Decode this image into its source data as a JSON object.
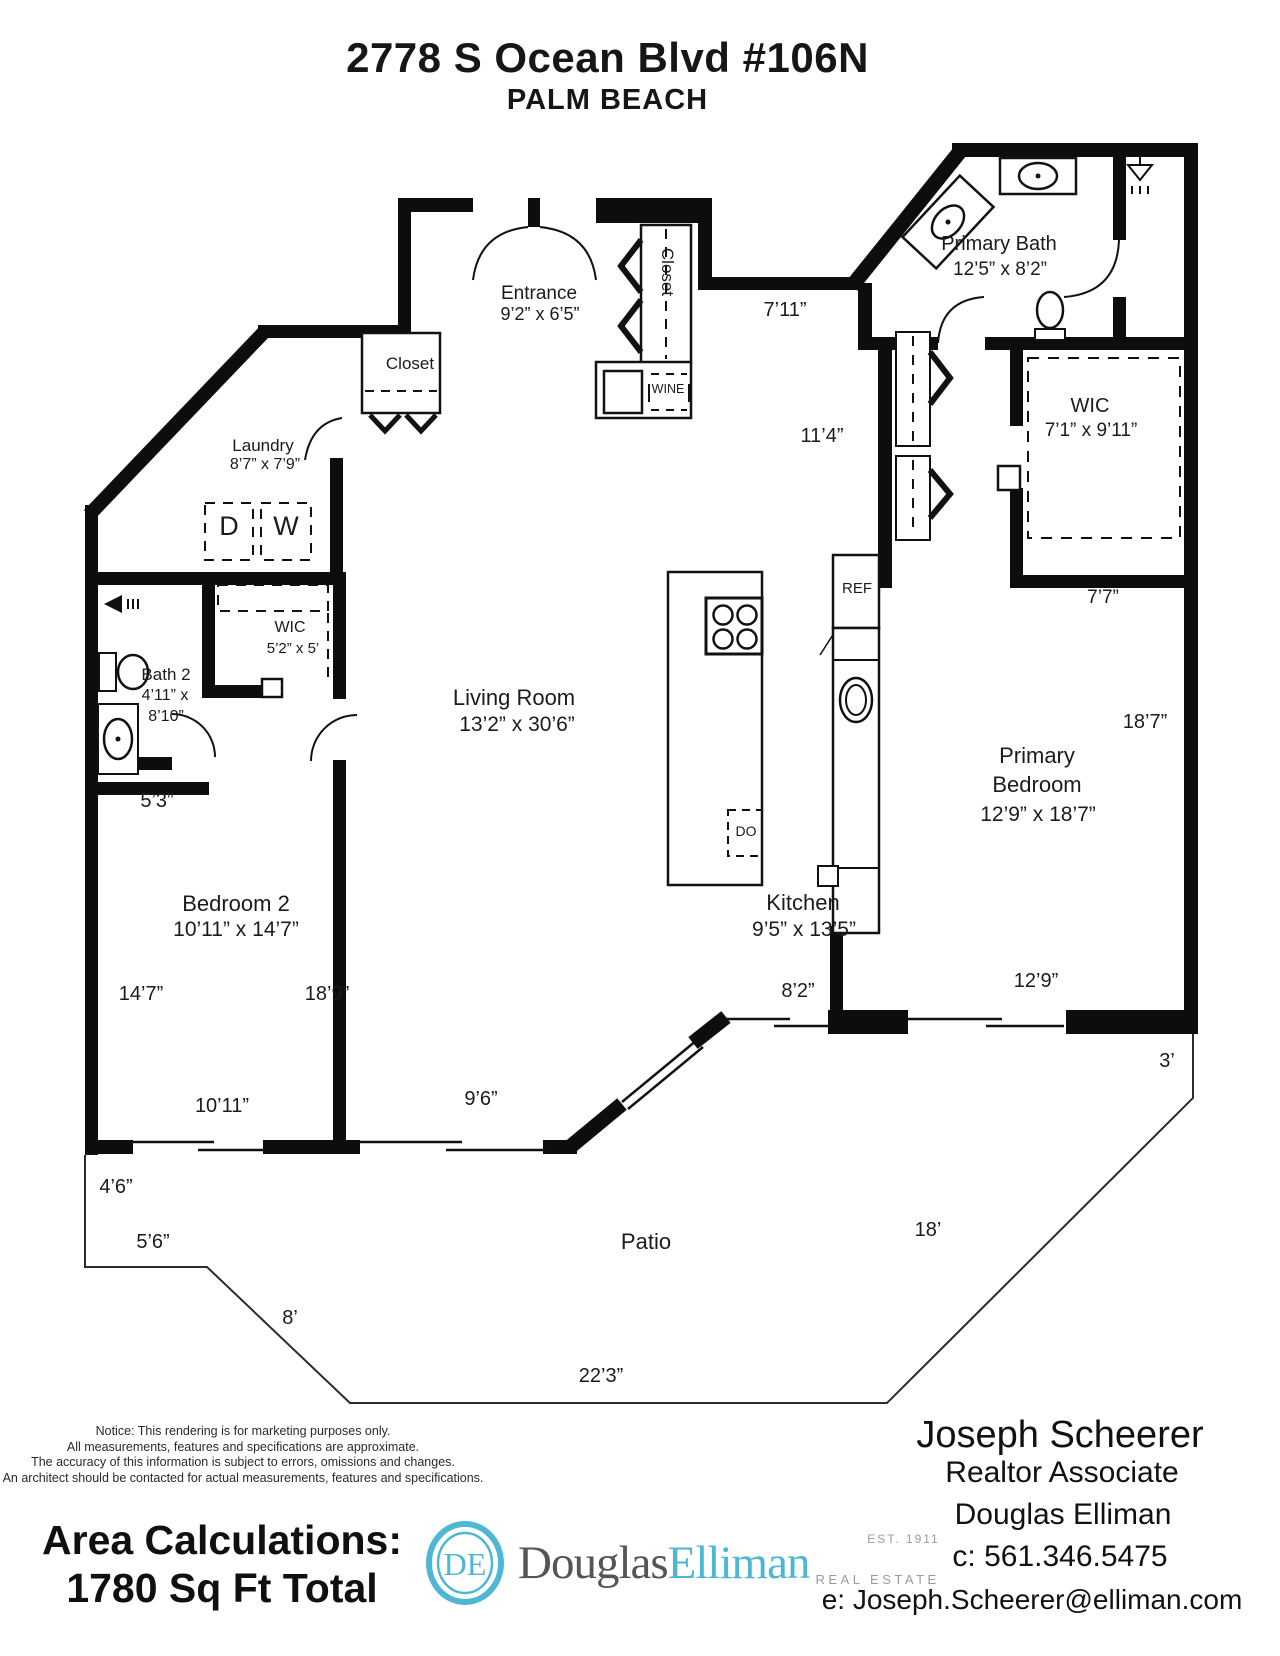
{
  "header": {
    "address": "2778 S Ocean Blvd #106N",
    "city": "PALM BEACH"
  },
  "rooms": {
    "entrance": {
      "name": "Entrance",
      "dims": "9’2” x 6’5”"
    },
    "foyer_closet": {
      "name": "Closet"
    },
    "hall_closet": {
      "name": "Closet"
    },
    "wine": {
      "label": "WINE"
    },
    "laundry": {
      "name": "Laundry",
      "dims": "8’7” x 7’9”",
      "dryer": "D",
      "washer": "W"
    },
    "bath2": {
      "name": "Bath 2",
      "dims1": "4’11” x",
      "dims2": "8’10”"
    },
    "wic2": {
      "name": "WIC",
      "dims": "5’2” x 5’"
    },
    "living": {
      "name": "Living Room",
      "dims": "13’2” x 30’6”"
    },
    "kitchen": {
      "name": "Kitchen",
      "dims": "9’5” x 13’5”",
      "ref": "REF",
      "do_label": "DO"
    },
    "primary_bath": {
      "name": "Primary Bath",
      "dims": "12’5” x 8’2”"
    },
    "wic1": {
      "name": "WIC",
      "dims": "7’1” x 9’11”"
    },
    "primary_bedroom": {
      "name1": "Primary",
      "name2": "Bedroom",
      "dims": "12’9” x 18’7”"
    },
    "bedroom2": {
      "name": "Bedroom 2",
      "dims": "10’11” x 14’7”"
    },
    "patio": {
      "name": "Patio"
    }
  },
  "dims": {
    "d7_11": "7’11”",
    "d11_4": "11’4”",
    "d7_7": "7’7”",
    "d18_7": "18’7”",
    "d5_3": "5’3”",
    "d14_7": "14’7”",
    "d18_9": "18’9”",
    "d10_11": "10’11”",
    "d9_6": "9’6”",
    "d8_2": "8’2”",
    "d12_9": "12’9”",
    "d3": "3’",
    "d4_6": "4’6”",
    "d5_6": "5’6”",
    "d8": "8’",
    "d22_3": "22’3”",
    "d18": "18’"
  },
  "footer": {
    "notice": [
      "Notice: This rendering is for marketing purposes only.",
      "All measurements, features and specifications are approximate.",
      "The accuracy of this information is subject to errors, omissions and changes.",
      "An architect should be contacted for actual measurements, features and specifications."
    ],
    "area_title": "Area Calculations:",
    "area_value": "1780 Sq Ft Total",
    "brand": {
      "monogram": "DE",
      "name1": "Douglas",
      "name2": "Elliman",
      "est": "EST. 1911",
      "tagline": "REAL ESTATE",
      "accent": "#4eb8d4"
    },
    "agent": {
      "name": "Joseph Scheerer",
      "title": "Realtor Associate",
      "company": "Douglas Elliman",
      "phone": "c: 561.346.5475",
      "email": "e: Joseph.Scheerer@elliman.com"
    }
  }
}
